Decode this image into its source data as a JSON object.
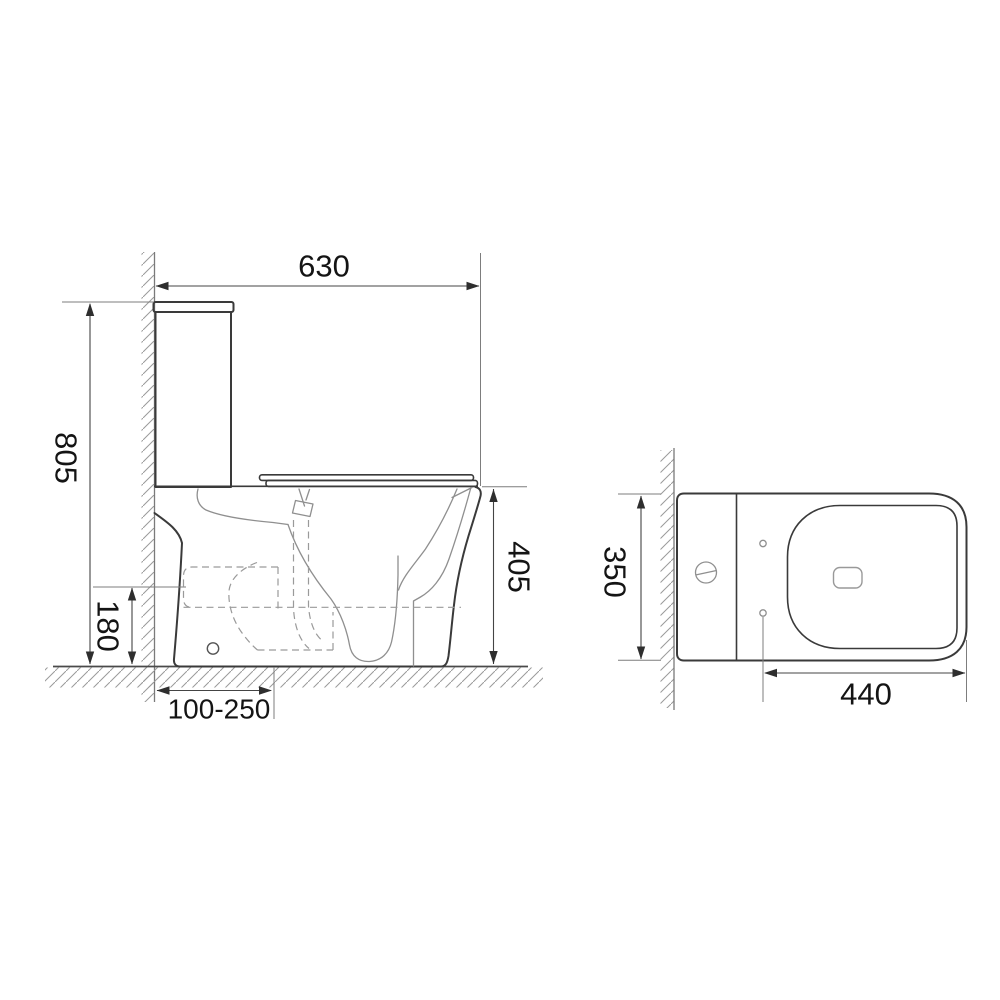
{
  "document": {
    "type": "technical-dimension-drawing",
    "subject": "two-piece toilet (cistern and bowl), side elevation and plan view",
    "background": "#ffffff"
  },
  "views": {
    "side": {
      "label": "side-elevation",
      "dimensions": {
        "overall_depth": "630",
        "overall_height": "805",
        "rim_height": "405",
        "outlet_height": "180",
        "rough_in": "100-250"
      }
    },
    "top": {
      "label": "plan-view",
      "dimensions": {
        "overall_width": "350",
        "bowl_length": "440"
      }
    }
  },
  "colors": {
    "outline": "#3a3a3a",
    "sketch_lines": "#8f8f8f",
    "hidden_dashed": "#9a9a9a",
    "dimension_lines": "#444444",
    "dimension_text": "#141414",
    "hatch": "#9a9a9a",
    "background": "#ffffff"
  }
}
